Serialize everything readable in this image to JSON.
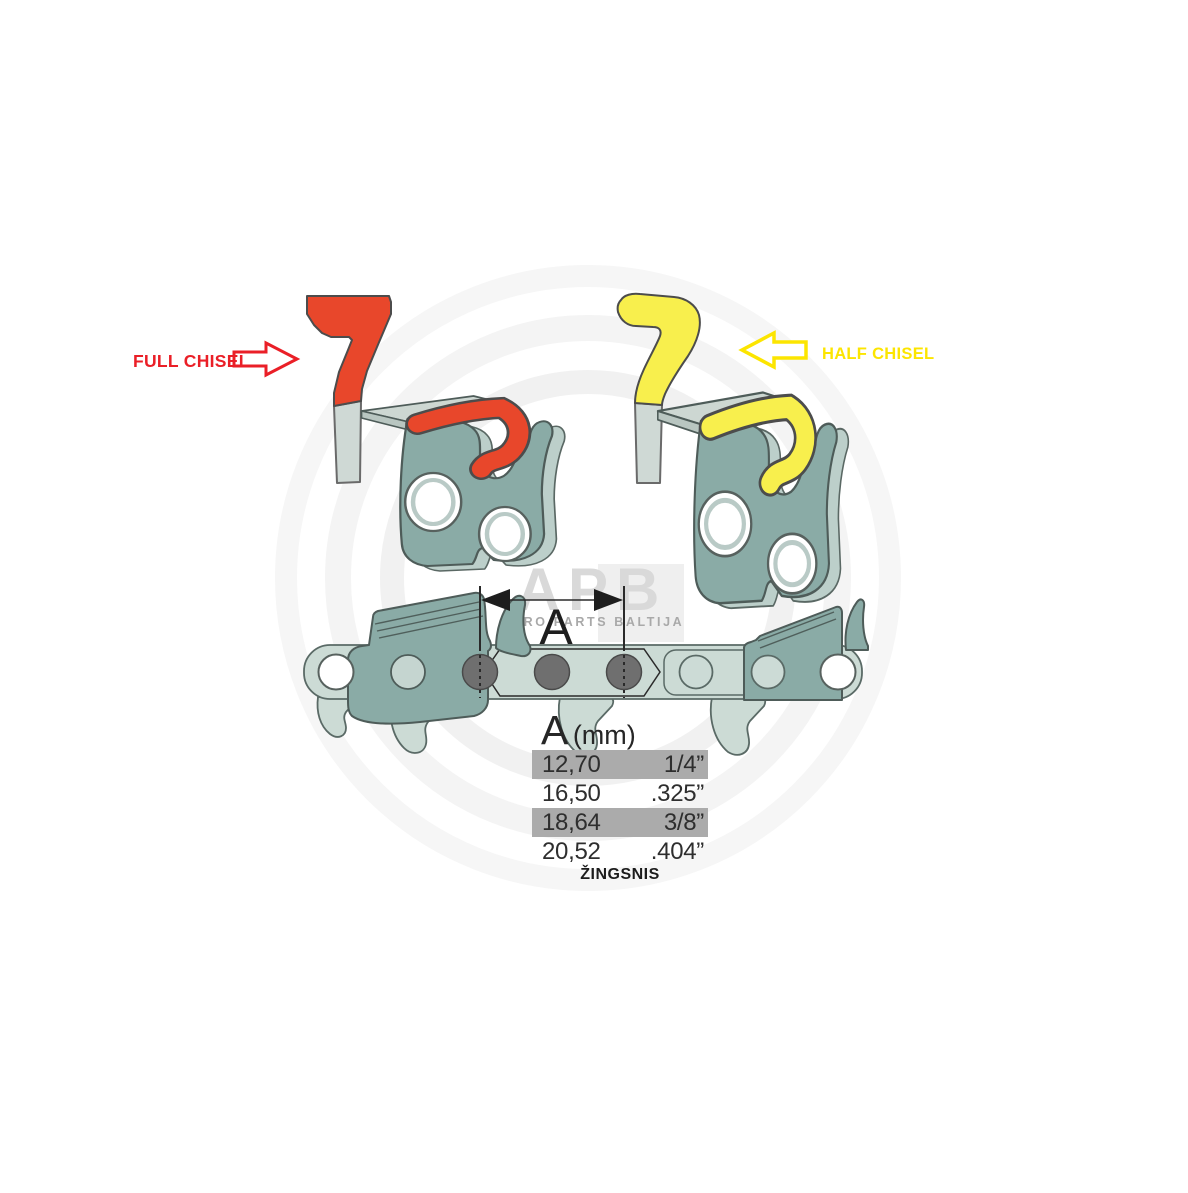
{
  "labels": {
    "full_chisel": "FULL CHISEL",
    "half_chisel": "HALF CHISEL",
    "dimension": "A"
  },
  "pitch_table": {
    "header_letter": "A",
    "header_unit": "(mm)",
    "rows": [
      {
        "mm": "12,70",
        "inch": "1/4”"
      },
      {
        "mm": "16,50",
        "inch": ".325”"
      },
      {
        "mm": "18,64",
        "inch": "3/8”"
      },
      {
        "mm": "20,52",
        "inch": ".404”"
      }
    ],
    "caption": "ŽINGSNIS"
  },
  "watermark": {
    "logo": "APB",
    "subtitle": "AGRO PARTS BALTIJA"
  },
  "colors": {
    "red_fill": "#e8472b",
    "red_label": "#ea1f27",
    "yellow_fill": "#f8ef4d",
    "yellow_label": "#fce500",
    "steel_teal": "#8aaba6",
    "steel_pale": "#ccdbd5",
    "row_highlight_gray": "#ababab",
    "rivet_gray": "#6f6f6f"
  }
}
